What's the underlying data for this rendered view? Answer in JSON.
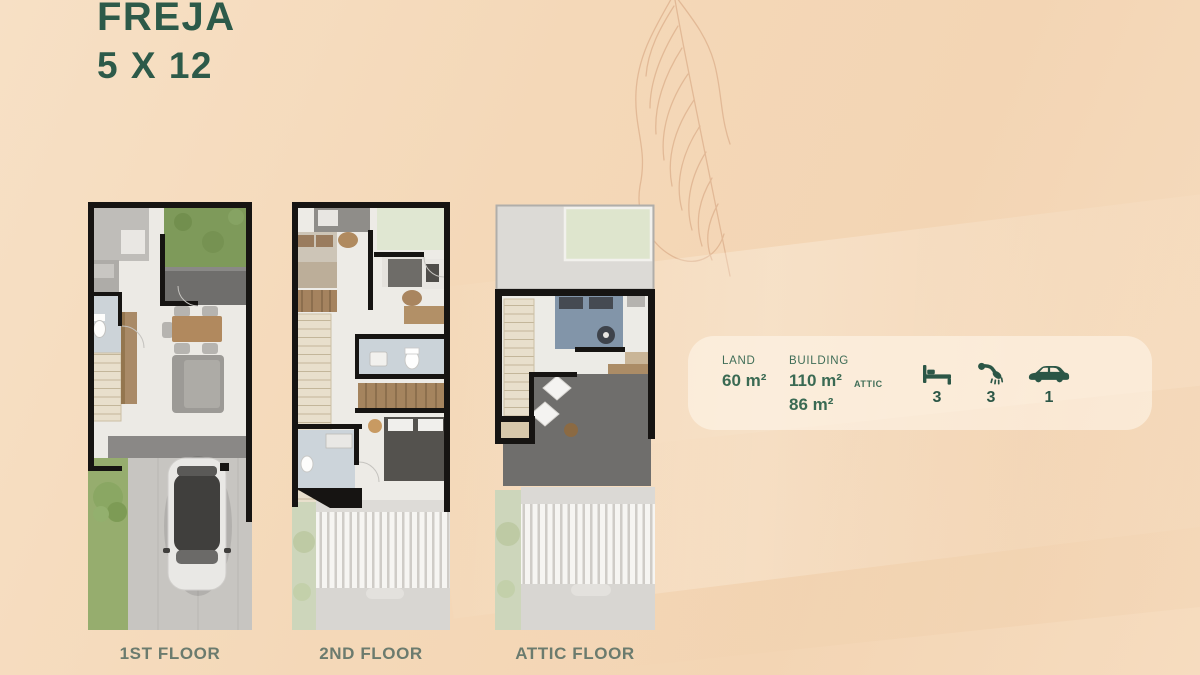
{
  "title": {
    "name": "FREJA",
    "size": "5 X 12"
  },
  "plans": [
    {
      "id": "first-floor",
      "label": "1ST FLOOR"
    },
    {
      "id": "second-floor",
      "label": "2ND FLOOR"
    },
    {
      "id": "attic-floor",
      "label": "ATTIC FLOOR"
    }
  ],
  "specs": {
    "land": {
      "label": "LAND",
      "value": "60 m²"
    },
    "building": {
      "label": "BUILDING",
      "value": "110 m²"
    },
    "attic": {
      "label": "ATTIC",
      "value": "86 m²"
    },
    "features": [
      {
        "icon": "bed-icon",
        "count": "3"
      },
      {
        "icon": "shower-icon",
        "count": "3"
      },
      {
        "icon": "car-icon",
        "count": "1"
      }
    ]
  },
  "colors": {
    "accent_green": "#2d5a49",
    "background_peach": "#f4d8b8",
    "floor_label": "#6b7b6e",
    "wall_black": "#161412"
  }
}
